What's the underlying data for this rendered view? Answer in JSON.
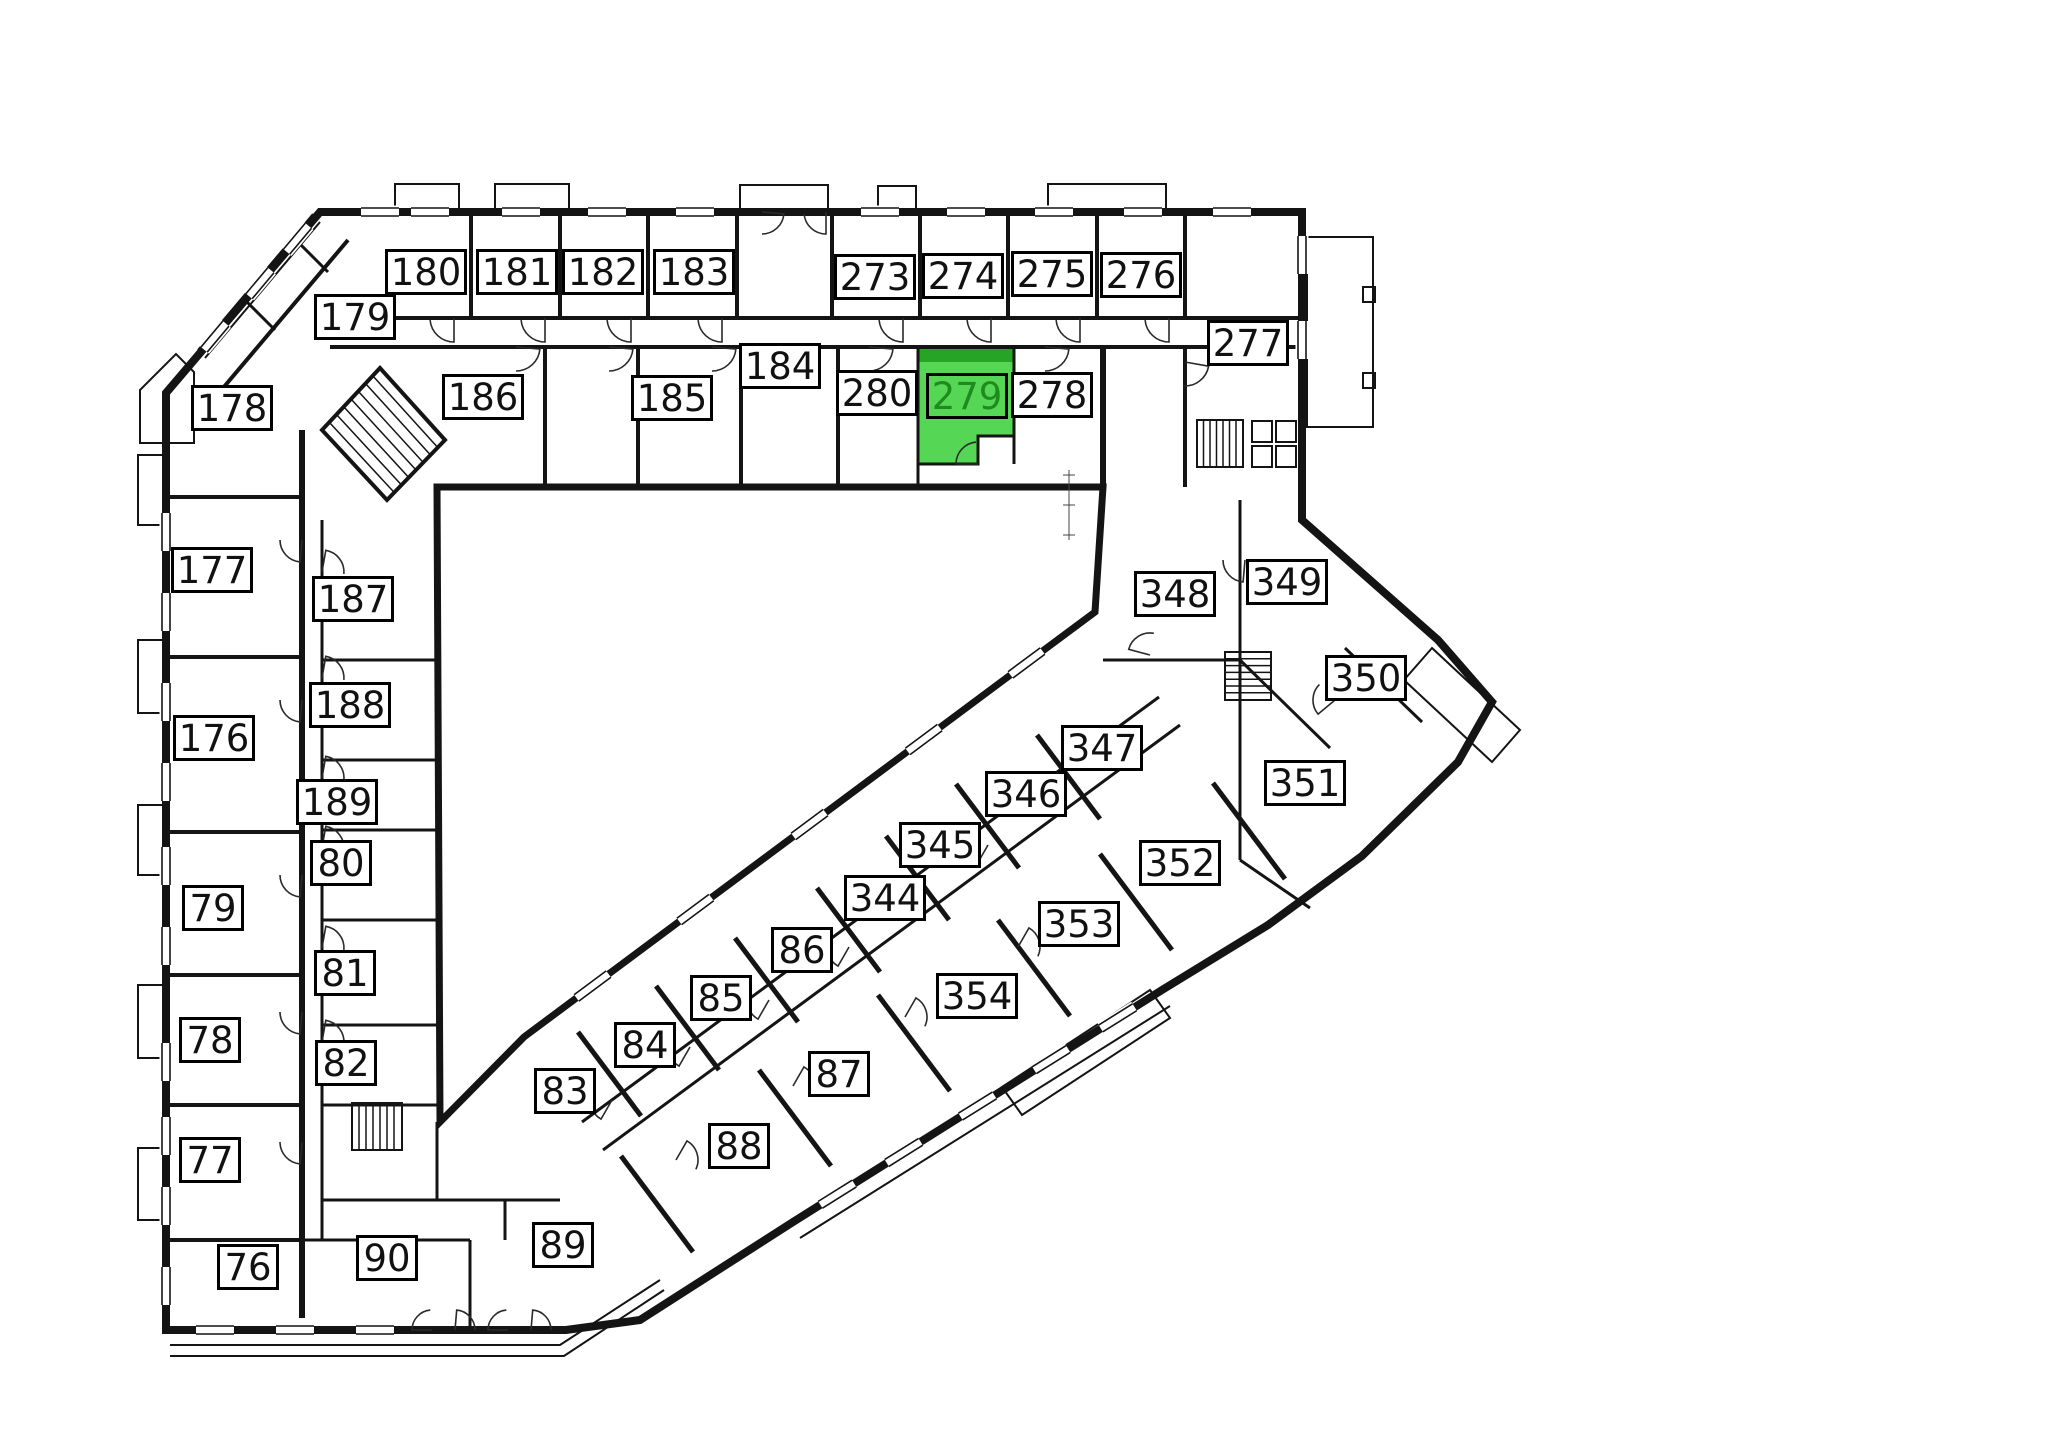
{
  "floorplan": {
    "type": "building-floor-plan",
    "highlighted_room": "279",
    "colors": {
      "wall": "#141414",
      "highlight_fill": "#55d655",
      "highlight_dark": "#25a425",
      "highlight_text": "#1f8a1f",
      "label_bg": "#ffffff",
      "label_border": "#000000",
      "label_text": "#111111",
      "background": "#ffffff"
    },
    "rooms": [
      {
        "n": "180",
        "x": 426,
        "y": 272
      },
      {
        "n": "181",
        "x": 517,
        "y": 272
      },
      {
        "n": "182",
        "x": 603,
        "y": 272
      },
      {
        "n": "183",
        "x": 694,
        "y": 272
      },
      {
        "n": "273",
        "x": 875,
        "y": 277
      },
      {
        "n": "274",
        "x": 963,
        "y": 276
      },
      {
        "n": "275",
        "x": 1052,
        "y": 274
      },
      {
        "n": "276",
        "x": 1141,
        "y": 275
      },
      {
        "n": "277",
        "x": 1248,
        "y": 343
      },
      {
        "n": "179",
        "x": 355,
        "y": 317
      },
      {
        "n": "184",
        "x": 780,
        "y": 366
      },
      {
        "n": "280",
        "x": 877,
        "y": 393
      },
      {
        "n": "279",
        "x": 967,
        "y": 396,
        "hl": true
      },
      {
        "n": "278",
        "x": 1052,
        "y": 395
      },
      {
        "n": "186",
        "x": 483,
        "y": 397
      },
      {
        "n": "185",
        "x": 672,
        "y": 398
      },
      {
        "n": "178",
        "x": 232,
        "y": 408
      },
      {
        "n": "177",
        "x": 212,
        "y": 570
      },
      {
        "n": "187",
        "x": 353,
        "y": 599
      },
      {
        "n": "176",
        "x": 214,
        "y": 738
      },
      {
        "n": "188",
        "x": 350,
        "y": 705
      },
      {
        "n": "189",
        "x": 337,
        "y": 802
      },
      {
        "n": "80",
        "x": 341,
        "y": 863
      },
      {
        "n": "79",
        "x": 213,
        "y": 908
      },
      {
        "n": "81",
        "x": 345,
        "y": 973
      },
      {
        "n": "78",
        "x": 210,
        "y": 1040
      },
      {
        "n": "82",
        "x": 346,
        "y": 1063
      },
      {
        "n": "77",
        "x": 210,
        "y": 1160
      },
      {
        "n": "76",
        "x": 248,
        "y": 1267
      },
      {
        "n": "90",
        "x": 387,
        "y": 1258
      },
      {
        "n": "83",
        "x": 565,
        "y": 1091
      },
      {
        "n": "84",
        "x": 645,
        "y": 1045
      },
      {
        "n": "85",
        "x": 721,
        "y": 998
      },
      {
        "n": "86",
        "x": 802,
        "y": 950
      },
      {
        "n": "87",
        "x": 839,
        "y": 1074
      },
      {
        "n": "88",
        "x": 739,
        "y": 1146
      },
      {
        "n": "89",
        "x": 563,
        "y": 1245
      },
      {
        "n": "344",
        "x": 885,
        "y": 898
      },
      {
        "n": "345",
        "x": 940,
        "y": 845
      },
      {
        "n": "346",
        "x": 1026,
        "y": 794
      },
      {
        "n": "347",
        "x": 1102,
        "y": 748
      },
      {
        "n": "348",
        "x": 1175,
        "y": 594
      },
      {
        "n": "349",
        "x": 1287,
        "y": 582
      },
      {
        "n": "350",
        "x": 1366,
        "y": 678
      },
      {
        "n": "351",
        "x": 1305,
        "y": 783
      },
      {
        "n": "352",
        "x": 1180,
        "y": 863
      },
      {
        "n": "353",
        "x": 1079,
        "y": 924
      },
      {
        "n": "354",
        "x": 977,
        "y": 996
      }
    ]
  }
}
